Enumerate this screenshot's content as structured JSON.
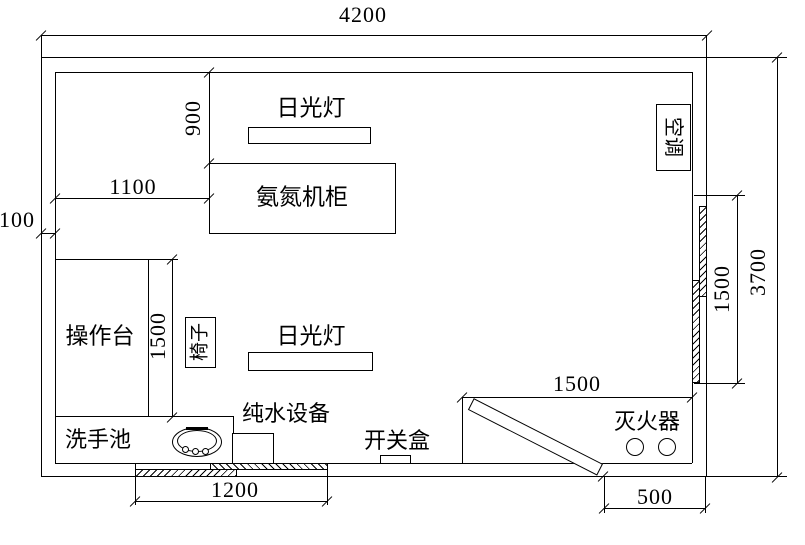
{
  "labels": {
    "lamp_top": "日光灯",
    "lamp_bottom": "日光灯",
    "cabinet": "氨氮机柜",
    "air_conditioner": "空调",
    "workbench": "操作台",
    "chair": "椅子",
    "sink": "洗手池",
    "pure_water_equipment": "纯水设备",
    "switch_box": "开关盒",
    "fire_extinguisher": "灭火器"
  },
  "dimensions": {
    "total_width": "4200",
    "total_height": "3700",
    "wall_thickness": "100",
    "cabinet_offset": "1100",
    "lamp_offset": "900",
    "workbench_length": "1500",
    "right_window": "1500",
    "extinguisher_area": "1500",
    "sliding_door": "1200",
    "door_offset": "500"
  },
  "colors": {
    "line": "#000000",
    "background": "#ffffff"
  }
}
